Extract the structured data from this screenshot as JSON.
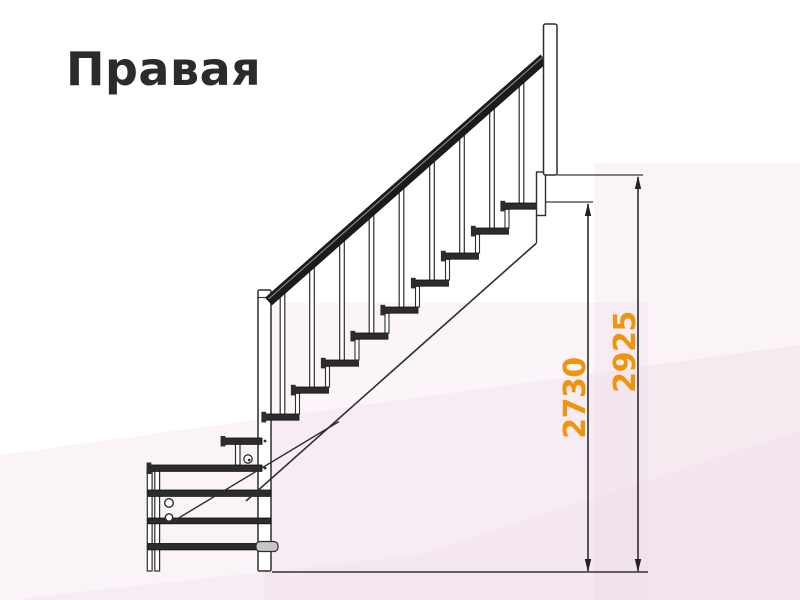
{
  "title": "Правая",
  "dimension_labels": {
    "inner": "2730",
    "outer": "2925"
  },
  "colors": {
    "dimension_text": "#EF940D",
    "line": "#3A3A3A",
    "accent_background": "#EED7E6"
  }
}
